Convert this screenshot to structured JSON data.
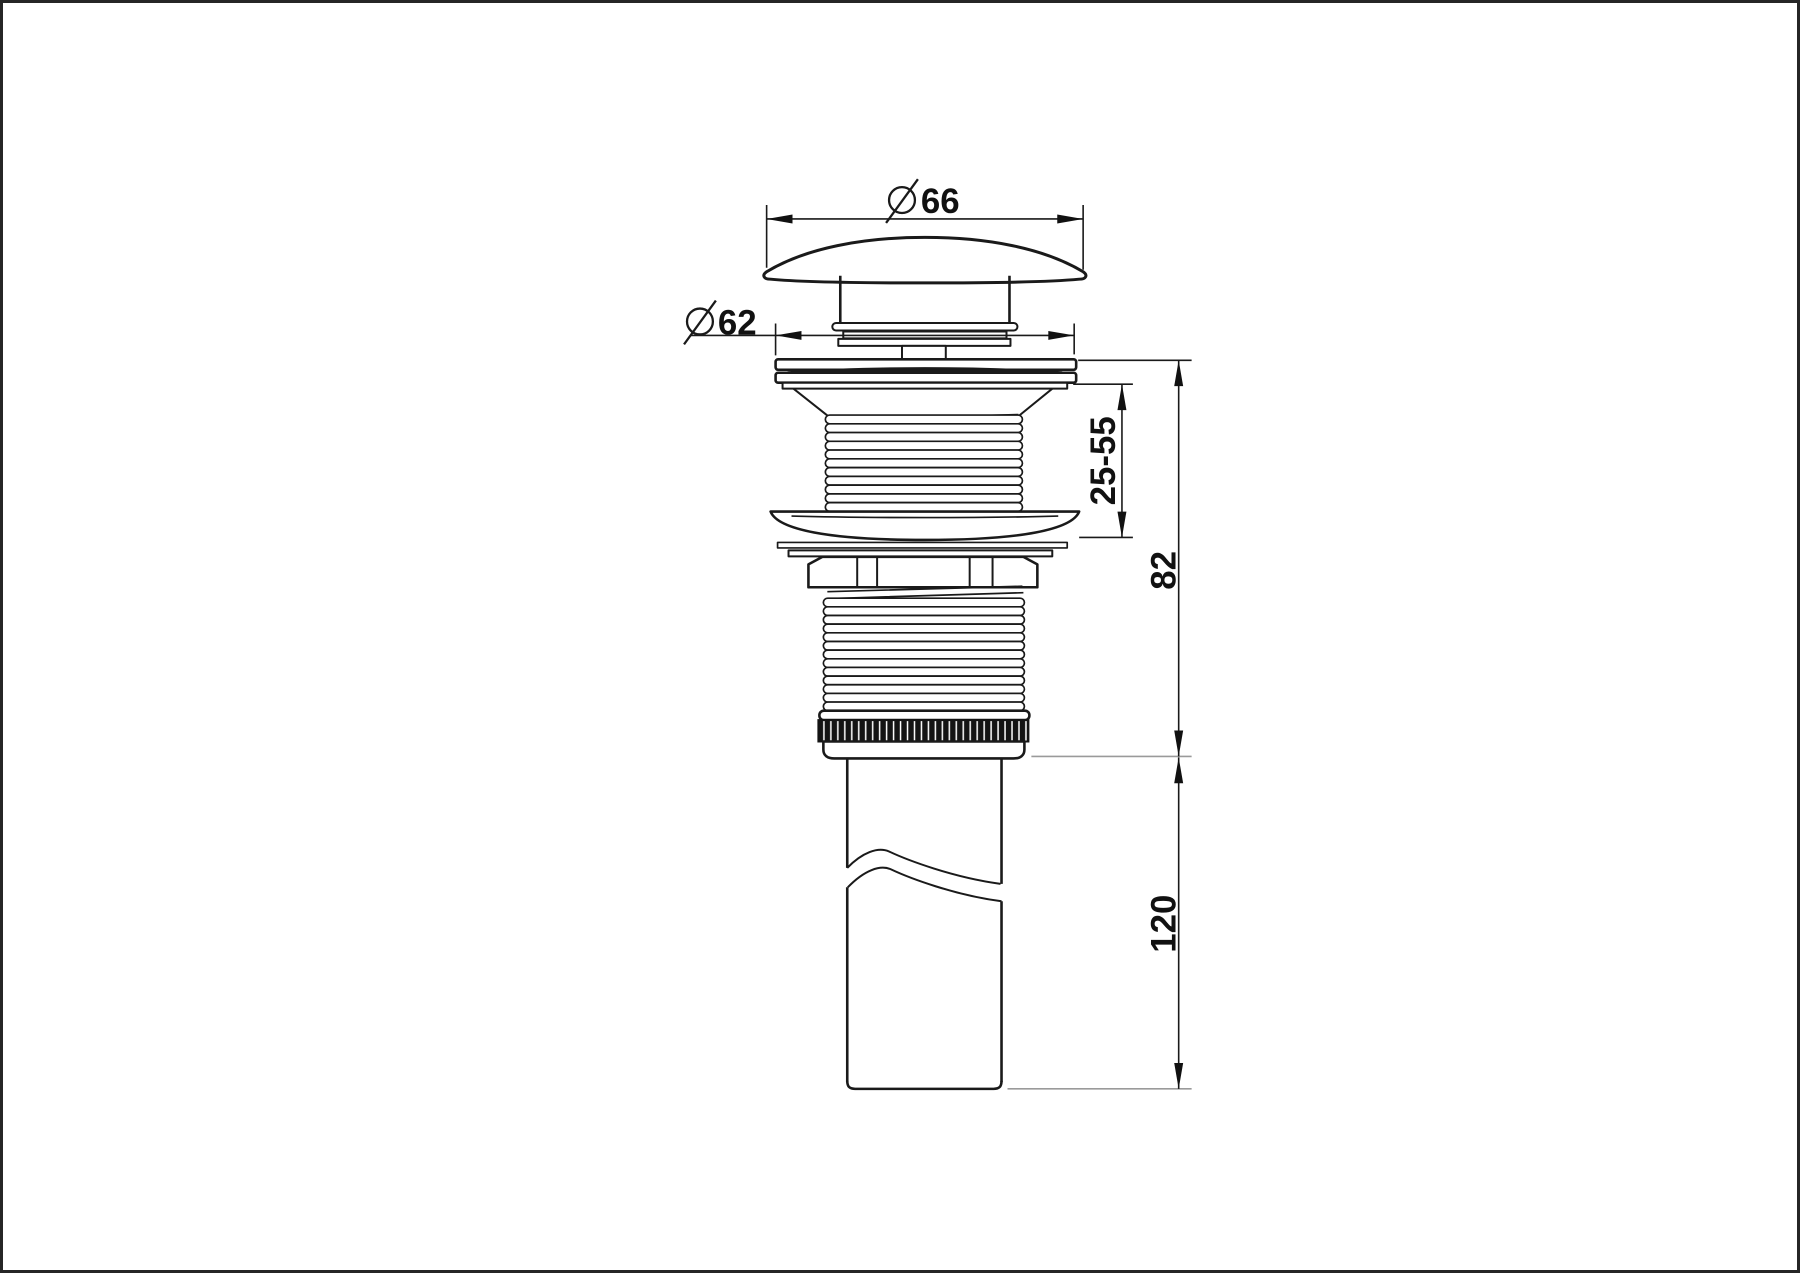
{
  "page": {
    "background": "#ffffff",
    "border_color": "#262626"
  },
  "dimensions": {
    "cap_diameter": {
      "symbol": "diameter",
      "value": "66"
    },
    "flange_diameter": {
      "symbol": "diameter",
      "value": "62"
    },
    "clamp_range": {
      "value": "25-55"
    },
    "body_height": {
      "value": "82"
    },
    "tailpipe_length": {
      "value": "120"
    }
  },
  "colors": {
    "line": "#1a1a1a",
    "extension_gray": "#9a9a9a",
    "text": "#111111",
    "knurl_fill": "#141414"
  }
}
